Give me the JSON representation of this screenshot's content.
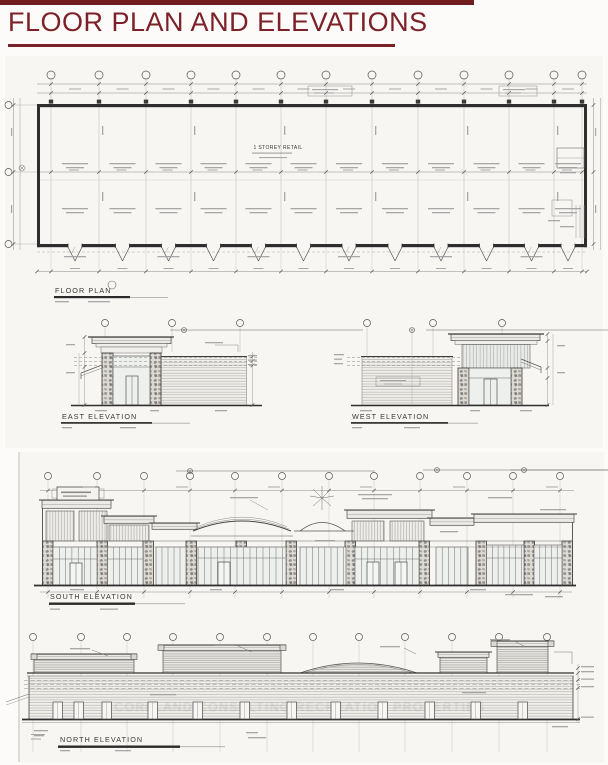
{
  "header": {
    "title": "FLOOR PLAN AND ELEVATIONS"
  },
  "sheet1": {
    "floor_plan": {
      "label": "FLOOR PLAN",
      "building_text": "1 STOREY RETAIL"
    },
    "east_elevation": {
      "label": "EAST ELEVATION"
    },
    "west_elevation": {
      "label": "WEST ELEVATION"
    }
  },
  "sheet2": {
    "south_elevation": {
      "label": "SOUTH ELEVATION"
    },
    "north_elevation": {
      "label": "NORTH ELEVATION"
    },
    "watermark": "CORELAND CONSULTING RECREATION PROPERTIES"
  },
  "colors": {
    "accent": "#7c2127",
    "ink": "#3f3f3f",
    "paper": "#f7f6f3"
  }
}
